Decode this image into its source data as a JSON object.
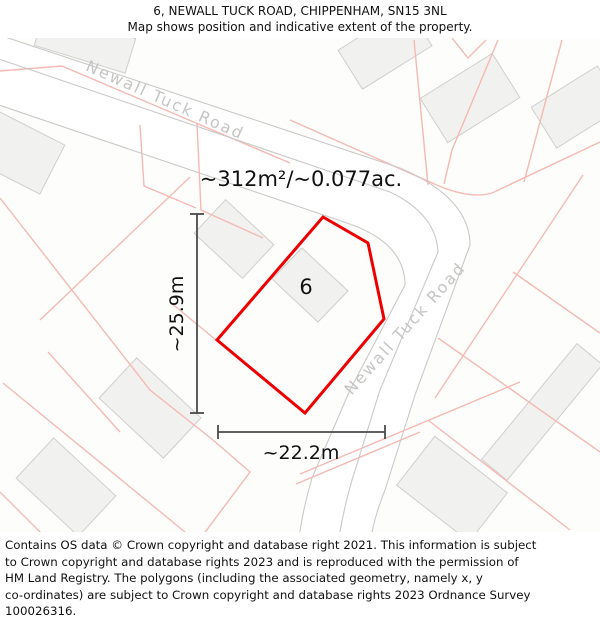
{
  "header": {
    "title": "6, NEWALL TUCK ROAD, CHIPPENHAM, SN15 3NL",
    "subtitle": "Map shows position and indicative extent of the property."
  },
  "map": {
    "area_label": "~312m²/~0.077ac.",
    "plot_number": "6",
    "width_label": "~22.2m",
    "height_label": "~25.9m",
    "road_label_upper": "Newall Tuck Road",
    "road_label_right": "Newall Tuck Road"
  },
  "footer": {
    "lines": [
      "Contains OS data © Crown copyright and database right 2021. This information is subject",
      "to Crown copyright and database rights 2023 and is reproduced with the permission of",
      "HM Land Registry. The polygons (including the associated geometry, namely x, y",
      "co-ordinates) are subject to Crown copyright and database rights 2023 Ordnance Survey",
      "100026316."
    ]
  },
  "colors": {
    "property_outline": "#ee0000",
    "parcel_line_pink": "#f5b9b3",
    "road_casing": "#c9c9c8",
    "road_label": "#c6c5c3",
    "building_fill": "#f1f1ef",
    "dimension": "#4a4a4a",
    "text": "#111111"
  }
}
